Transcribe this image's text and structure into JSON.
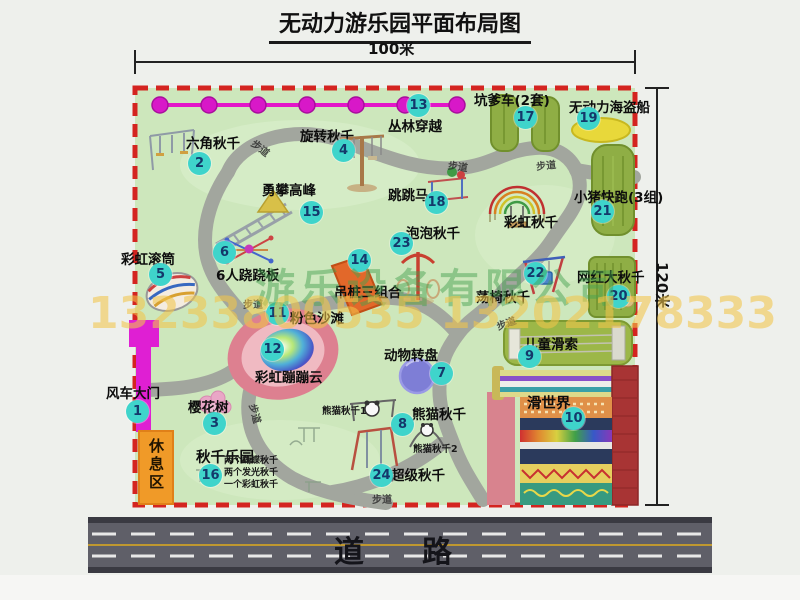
{
  "title": "无动力游乐园平面布局图",
  "dim": {
    "width": "100米",
    "height": "120米"
  },
  "road": {
    "label": "道　路"
  },
  "rest_area": "休息区",
  "walkway": "步道",
  "watermark": {
    "company": "游乐设备有限公司",
    "phone": "13233800535 13202178333"
  },
  "attractions": [
    {
      "num": "1",
      "label": "风车大门"
    },
    {
      "num": "2",
      "label": "六角秋千"
    },
    {
      "num": "3",
      "label": "樱花树"
    },
    {
      "num": "4",
      "label": "旋转秋千"
    },
    {
      "num": "5",
      "label": "彩虹滚筒"
    },
    {
      "num": "6",
      "label": "6人跷跷板"
    },
    {
      "num": "7",
      "label": "动物转盘"
    },
    {
      "num": "8",
      "label": "熊猫秋千"
    },
    {
      "num": "9",
      "label": "儿童滑索"
    },
    {
      "num": "10",
      "label": "滑世界"
    },
    {
      "num": "11",
      "label": "粉色沙滩"
    },
    {
      "num": "12",
      "label": "彩虹蹦蹦云"
    },
    {
      "num": "13",
      "label": "丛林穿越"
    },
    {
      "num": "14",
      "label": "吊桩三组合"
    },
    {
      "num": "15",
      "label": "勇攀高峰"
    },
    {
      "num": "16",
      "label": "秋千乐园"
    },
    {
      "num": "17",
      "label": "坑爹车(2套)"
    },
    {
      "num": "18",
      "label": "跳跳马"
    },
    {
      "num": "19",
      "label": "无动力海盗船"
    },
    {
      "num": "20",
      "label": "网红大秋千"
    },
    {
      "num": "21",
      "label": "小猪快跑(3组)"
    },
    {
      "num": "22",
      "label": "荡椅秋千"
    },
    {
      "num": "23",
      "label": "泡泡秋千"
    },
    {
      "num": "24",
      "label": "超级秋千"
    }
  ],
  "unnumbered": {
    "rainbow_swing": "彩虹秋千",
    "panda_swing_1": "熊猫秋千1",
    "panda_swing_2": "熊猫秋千2"
  },
  "swing_park_notes": [
    "两个蝴蝶秋千",
    "两个发光秋千",
    "一个彩虹秋千"
  ],
  "colors": {
    "map_bg": "#cde7bc",
    "border_red": "#d42420",
    "marker_cyan": "#3fd4cb",
    "gate_magenta": "#df1fd3",
    "zipline_magenta": "#e316c9",
    "road_gray": "#5f5f68",
    "rest_orange": "#f09a28",
    "strip_olive": "#8fae45"
  }
}
